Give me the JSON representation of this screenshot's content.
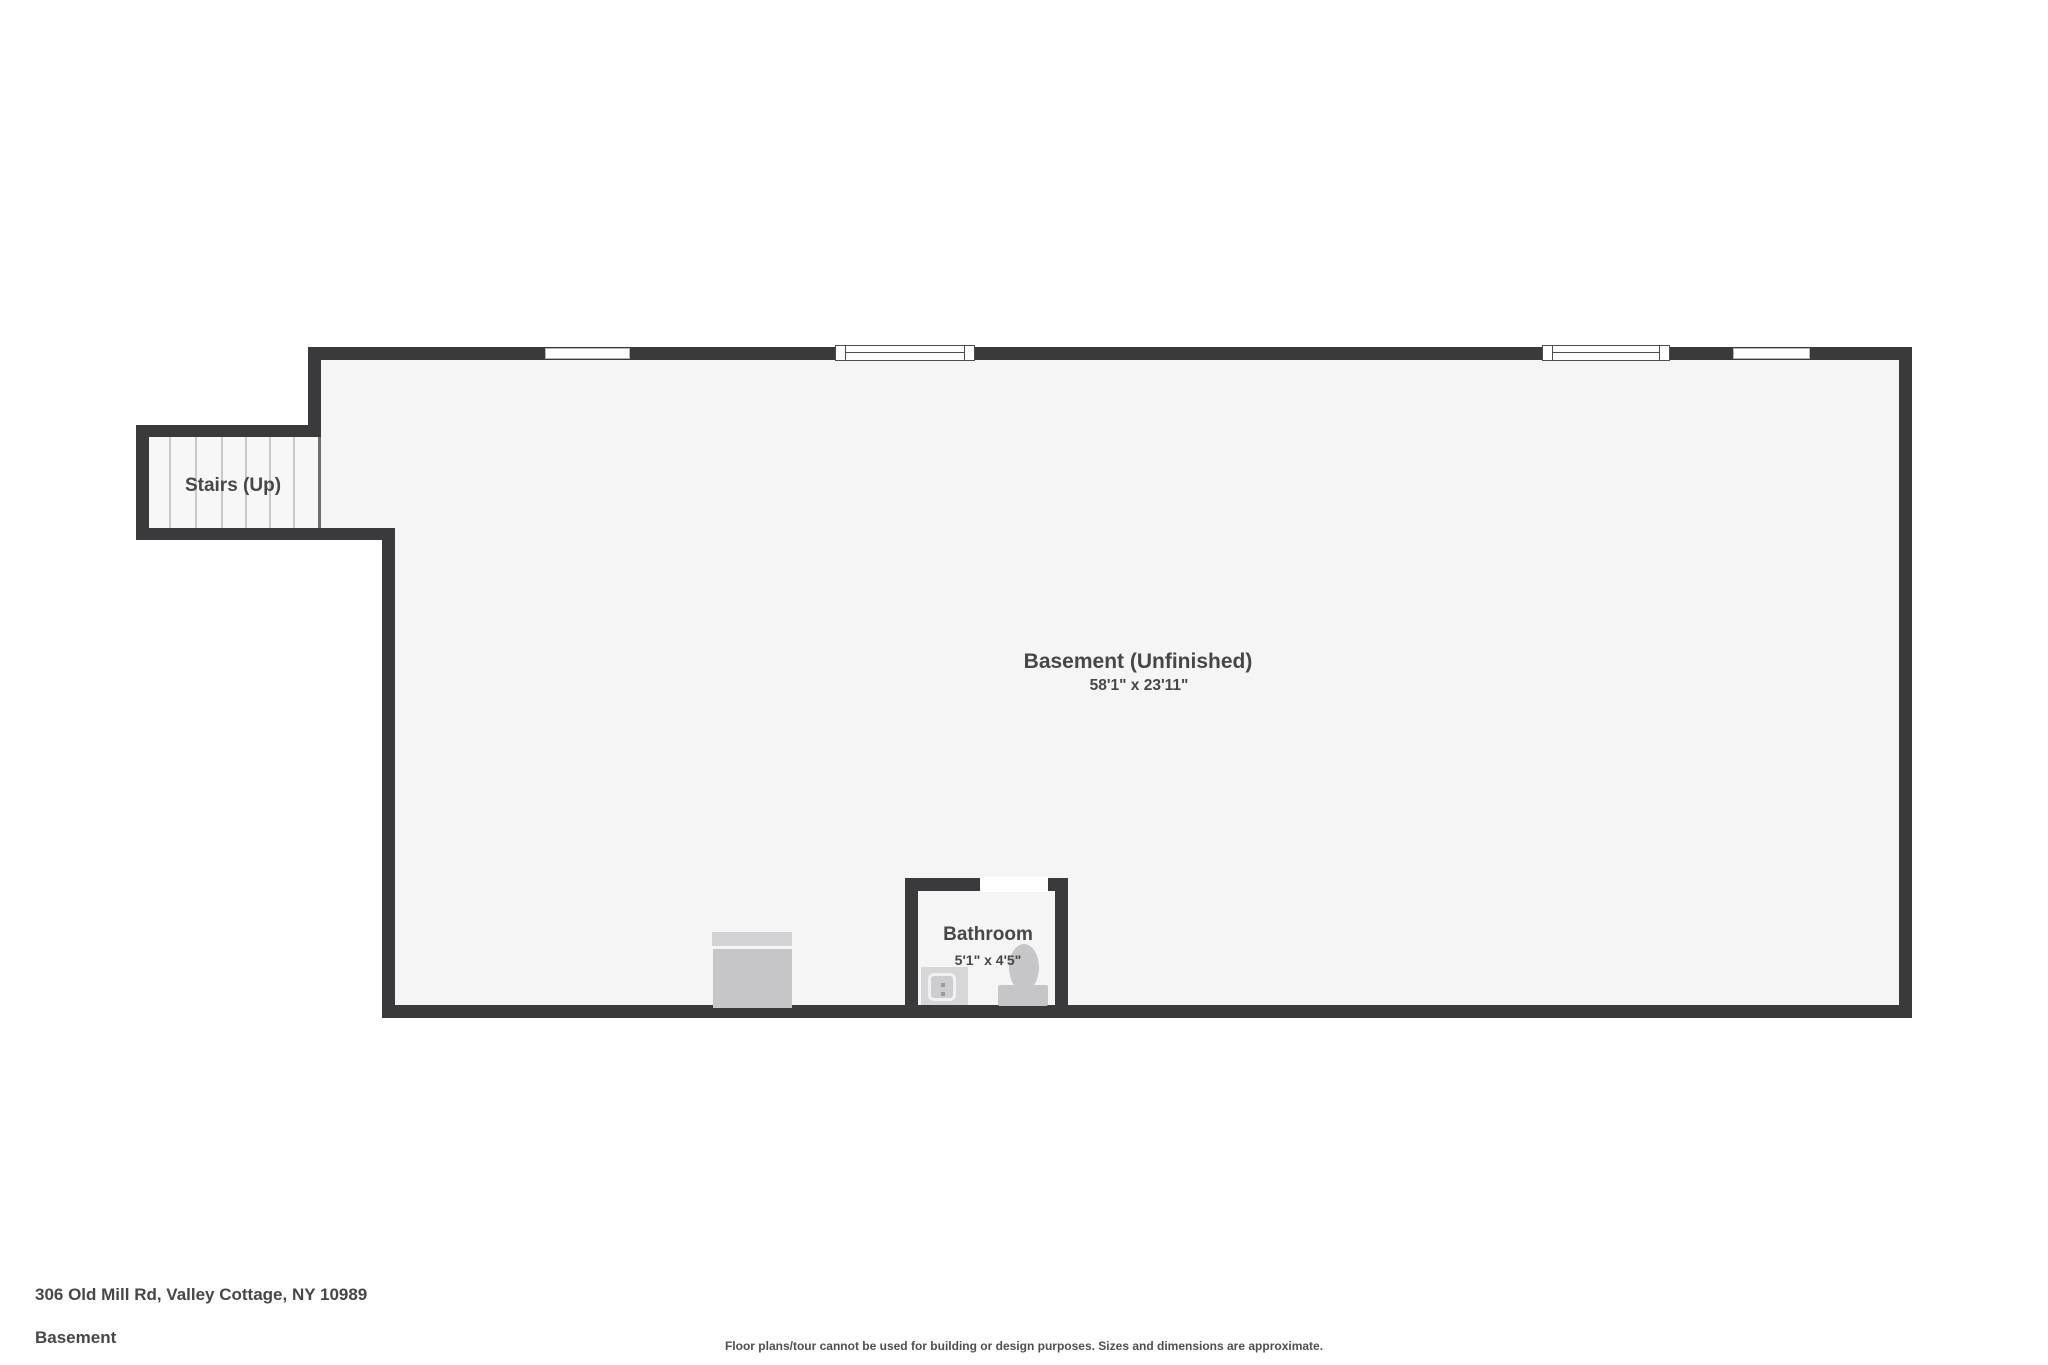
{
  "plan": {
    "stairs": {
      "label": "Stairs (Up)"
    },
    "room": {
      "name": "Basement (Unfinished)",
      "dimensions": "58'1\" x 23'11\""
    },
    "bathroom": {
      "name": "Bathroom",
      "dimensions": "5'1\" x 4'5\""
    },
    "features": {
      "windows": 2,
      "wall_openings": 2,
      "fixture_icons": [
        "washer-icon",
        "sink-icon",
        "toilet-icon"
      ]
    }
  },
  "footer": {
    "address": "306 Old Mill Rd, Valley Cottage, NY 10989",
    "floor_name": "Basement",
    "disclaimer": "Floor plans/tour cannot be used for building or design purposes. Sizes and dimensions are approximate."
  },
  "colors": {
    "wall": "#3a3a3c",
    "floor": "#f5f5f6",
    "background": "#ffffff",
    "fixture": "#c6c6c8",
    "fixture_light": "#d2d2d4",
    "tread": "#c9c9c9",
    "text": "#474747"
  }
}
